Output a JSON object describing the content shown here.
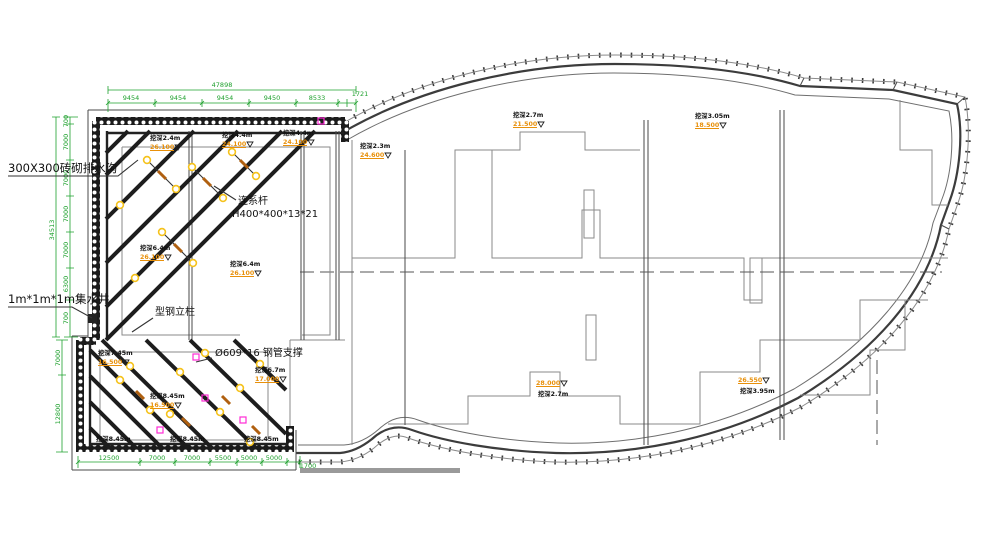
{
  "labels": {
    "drain_channel": "300X300砖砌排水沟",
    "sump_pit": "1m*1m*1m集水井",
    "steel_column": "型钢立柱",
    "tie_rod_line1": "连系杆",
    "tie_rod_line2": "H400*400*13*21",
    "pipe_support": "Ø609*16 钢管支撑"
  },
  "dimensions": {
    "top_total": "47898",
    "top_segments": [
      "9454",
      "9454",
      "9454",
      "9450",
      "8533",
      "1721"
    ],
    "left_total": "34513",
    "left_upper_segments": [
      "700",
      "7000",
      "7000",
      "7000",
      "7000",
      "6300",
      "700"
    ],
    "left_lower_segments": [
      "7000",
      "12800"
    ],
    "bottom_segments": [
      "12500",
      "7000",
      "7000",
      "5500",
      "5000",
      "5000",
      "1700"
    ]
  },
  "elevation_markers": [
    {
      "depth": "挖深2.4m",
      "elev": "26.100"
    },
    {
      "depth": "挖深4.4m",
      "elev": "24.100"
    },
    {
      "depth": "挖深4.4m",
      "elev": "24.100"
    },
    {
      "depth": "挖深6.4m",
      "elev": "26.100"
    },
    {
      "depth": "挖深6.4m",
      "elev": "26.100"
    },
    {
      "depth": "挖深2.3m",
      "elev": "24.600"
    },
    {
      "depth": "挖深2.7m",
      "elev": "21.500"
    },
    {
      "depth": "挖深3.05m",
      "elev": "18.500"
    },
    {
      "depth": "挖深2.7m",
      "elev": "28.000"
    },
    {
      "depth": "挖深3.95m",
      "elev": "26.550"
    },
    {
      "depth": "挖深6.7m",
      "elev": "17.000"
    },
    {
      "depth": "挖深7.45m",
      "elev": "16.500"
    },
    {
      "depth": "挖深8.45m",
      "elev": "16.500"
    }
  ],
  "bottom_depth_labels": [
    "挖深8.45m",
    "挖深8.45m",
    "挖深8.45m"
  ],
  "colors": {
    "dimension_green": "#1fa12e",
    "elevation_orange": "#e8900a",
    "brace_black": "#1d1d1d",
    "line_gray": "#8a8a8a",
    "magenta": "#ff2bd6",
    "joint_yellow": "#f5c21b"
  }
}
